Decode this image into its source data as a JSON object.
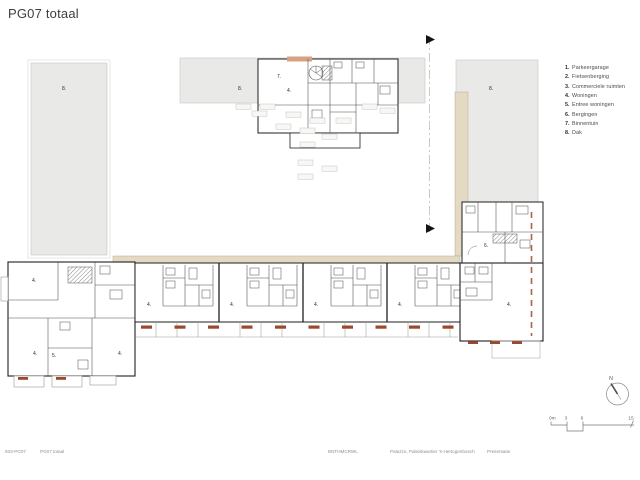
{
  "title": "PG07 totaal",
  "legend": {
    "items": [
      {
        "num": "1.",
        "label": "Parkeergarage"
      },
      {
        "num": "2.",
        "label": "Fietsenberging"
      },
      {
        "num": "3.",
        "label": "Commerciele ruimten"
      },
      {
        "num": "4.",
        "label": "Woningen"
      },
      {
        "num": "5.",
        "label": "Entree woningen"
      },
      {
        "num": "6.",
        "label": "Bergingen"
      },
      {
        "num": "7.",
        "label": "Binnentuin"
      },
      {
        "num": "8.",
        "label": "Dak"
      }
    ]
  },
  "plan": {
    "labels": [
      {
        "x": 62,
        "y": 90,
        "t": "8."
      },
      {
        "x": 238,
        "y": 90,
        "t": "8."
      },
      {
        "x": 489,
        "y": 90,
        "t": "8."
      },
      {
        "x": 277,
        "y": 78,
        "t": "7."
      },
      {
        "x": 287,
        "y": 92,
        "t": "4."
      },
      {
        "x": 32,
        "y": 282,
        "t": "4."
      },
      {
        "x": 33,
        "y": 355,
        "t": "4."
      },
      {
        "x": 118,
        "y": 355,
        "t": "4."
      },
      {
        "x": 52,
        "y": 357,
        "t": "5."
      },
      {
        "x": 147,
        "y": 306,
        "t": "4."
      },
      {
        "x": 230,
        "y": 306,
        "t": "4."
      },
      {
        "x": 314,
        "y": 306,
        "t": "4."
      },
      {
        "x": 398,
        "y": 306,
        "t": "4."
      },
      {
        "x": 507,
        "y": 306,
        "t": "4."
      },
      {
        "x": 484,
        "y": 247,
        "t": "6."
      }
    ],
    "colors": {
      "roof": "#e9e9e7",
      "gallery": "#e4d9c3",
      "accent": "#d8a183",
      "marker": "#9a4a2c",
      "wall": "#1f1f1f"
    }
  },
  "north": {
    "label": "N"
  },
  "scalebar": {
    "ticks": [
      {
        "x": 549,
        "label": "0m",
        "anchor": "start"
      },
      {
        "x": 566,
        "label": "3",
        "anchor": "middle"
      },
      {
        "x": 582,
        "label": "6",
        "anchor": "middle"
      },
      {
        "x": 631,
        "label": "15",
        "anchor": "middle"
      }
    ]
  },
  "footer": {
    "doc_code": "933-PG07",
    "doc_title": "PG07 totaal",
    "firm": "BNTHMCRWL",
    "project": "Palazzo, Paleiskwartier 's-Hertogenbosch",
    "phase": "Presentatie"
  }
}
